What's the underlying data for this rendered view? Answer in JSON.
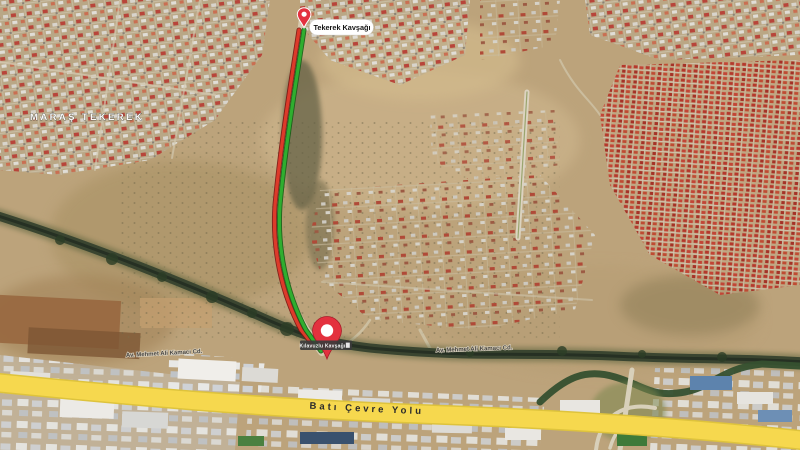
{
  "map": {
    "locality_label": "MARAŞ TEKEREK",
    "start_pin": {
      "label": "Tekerek Kavşağı"
    },
    "end_pin": {
      "label": "Kılavuzlu Kavşağı"
    },
    "streets": {
      "label_1": "Av. Mehmet Ali Kamacı Cd.",
      "label_2": "Av. Mehmet Ali Kamacı Cd."
    },
    "highway": {
      "label": "Batı Çevre Yolu"
    },
    "colors": {
      "terrain_tan": "#bca37b",
      "route_green": "#2fae2f",
      "route_red": "#dd3a2a",
      "pin_red": "#e3313e",
      "highway_yellow": "#f6d84e",
      "canal_dark": "#3a4530",
      "dense_roofs_red": "#b5382c",
      "label_strip_gray": "#3b3b3b"
    }
  }
}
